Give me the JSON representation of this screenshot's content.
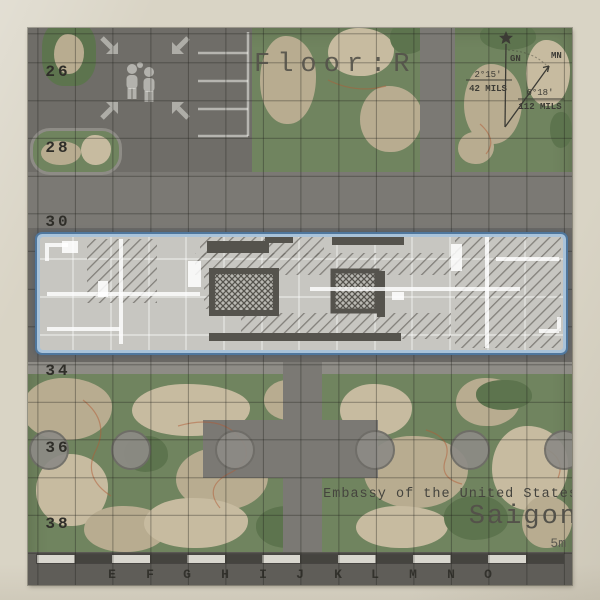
{
  "map": {
    "floor_label": "Floor:R",
    "title": "Embassy of the United States",
    "subtitle": "Saigon",
    "scale_label": "5m",
    "grid": {
      "rows": [
        "26",
        "28",
        "30",
        "34",
        "36",
        "38"
      ],
      "cols": [
        "E",
        "F",
        "G",
        "H",
        "I",
        "J",
        "K",
        "L",
        "M",
        "N",
        "O"
      ]
    },
    "compass": {
      "grid_north_label": "GN",
      "magnetic_north_label": "MN",
      "gn_angle": "2°15'",
      "gn_mils": "42 MILS",
      "mn_angle": "6°18'",
      "mn_mils": "112 MILS"
    }
  },
  "colors": {
    "paper": "#d9d4c5",
    "map-green": "#70845f",
    "green-dark": "#5d744e",
    "tan": "#b8ac90",
    "tan-light": "#c7bba0",
    "road": "#7b7974",
    "road-dark": "#6f6d68",
    "apron": "#6b6965",
    "sidewalk": "#8e8c86",
    "bar": "#5f5d58",
    "bar-dark-seg": "#45443f",
    "bar-light-seg": "#d9d7cf",
    "roof": "#c7c6c1",
    "roof-hatch": "#6e6c66",
    "wall": "#55534d",
    "highlight-outer": "#4f779e",
    "highlight-inner": "#a9c3da",
    "tree-fill": "#8d8b86",
    "tree-ring": "#6e6c67",
    "contour": "#b25c36"
  }
}
